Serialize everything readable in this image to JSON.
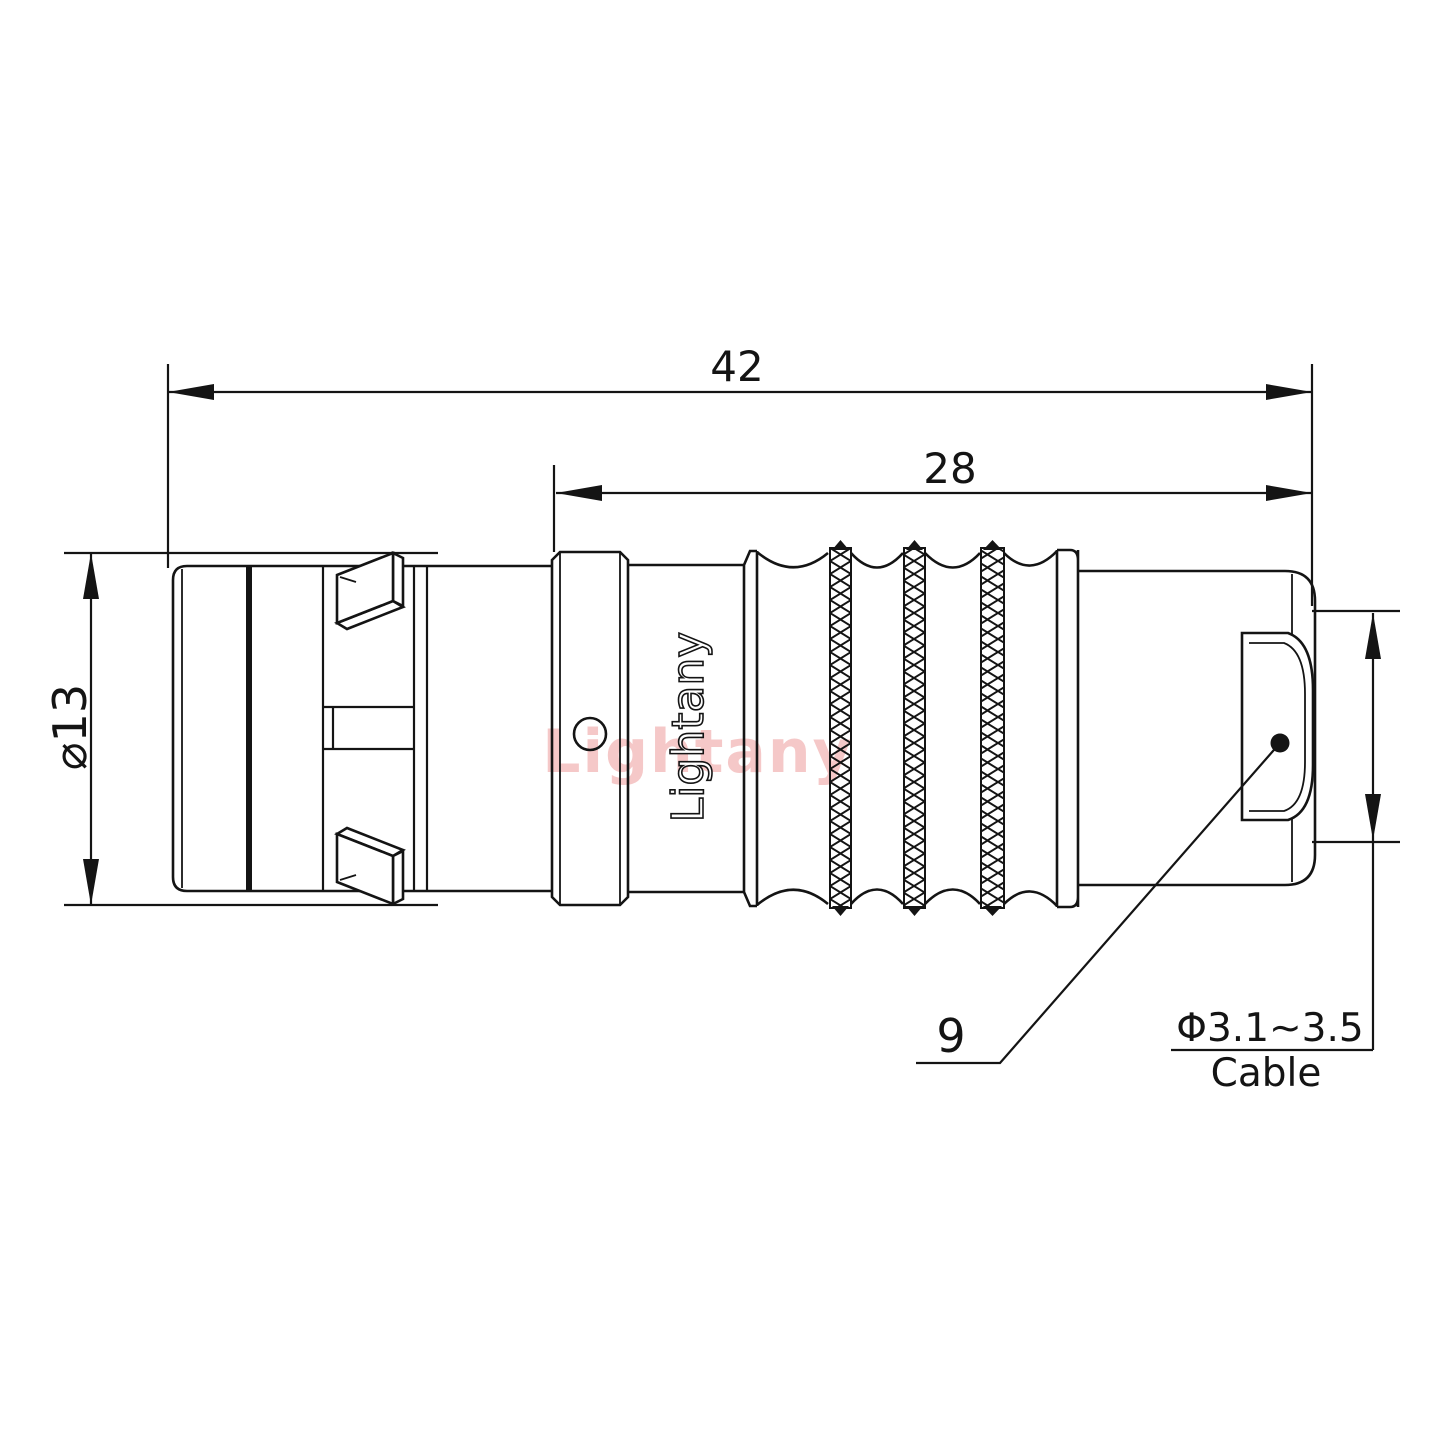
{
  "drawing": {
    "type": "connector-technical-drawing",
    "dimensions": {
      "overall_length": "42",
      "rear_length": "28",
      "body_diameter": "⌀13",
      "ref_number": "9",
      "cable_range": "Φ3.1~3.5",
      "cable_word": "Cable"
    },
    "branding": {
      "engraving": "Lightany",
      "watermark": "Lightany"
    },
    "colors": {
      "line": "#141414",
      "watermark": "#f5c8c8",
      "background": "#ffffff"
    }
  }
}
